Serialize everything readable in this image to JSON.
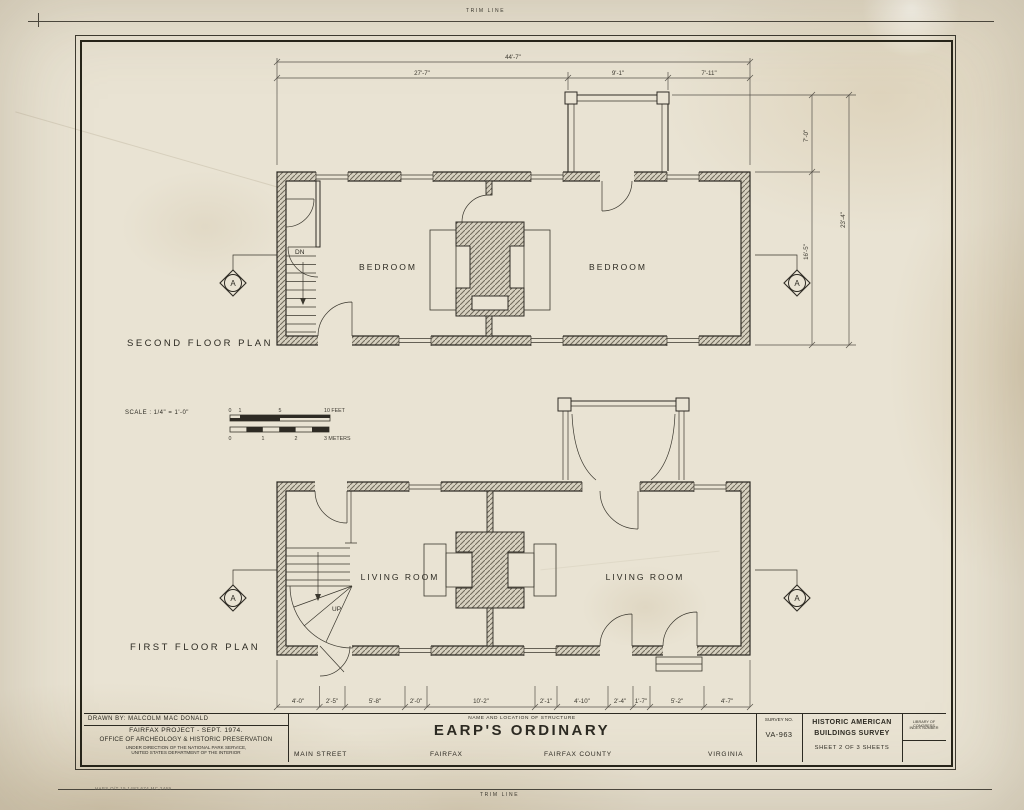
{
  "sheet": {
    "trim_top": "TRIM LINE",
    "trim_bottom": "TRIM LINE",
    "print_code": "HABS O/T 15 1483 674 MC 2469"
  },
  "plans": {
    "second": {
      "title": "SECOND FLOOR PLAN",
      "room_left": "BEDROOM",
      "room_right": "BEDROOM",
      "stair": "DN"
    },
    "first": {
      "title": "FIRST FLOOR PLAN",
      "room_left": "LIVING ROOM",
      "room_right": "LIVING ROOM",
      "stair": "UP"
    }
  },
  "marker": {
    "letter": "A"
  },
  "dims": {
    "top_overall": "44'-7\"",
    "top": [
      "27'-7\"",
      "9'-1\"",
      "7'-11\""
    ],
    "right": {
      "upper": "7'-0\"",
      "lower": "16'-5\"",
      "overall": "23'-4\""
    },
    "bottom": [
      "4'-0\"",
      "2'-5\"",
      "5'-8\"",
      "2'-0\"",
      "10'-2\"",
      "2'-1\"",
      "4'-10\"",
      "2'-4\"",
      "1'-7\"",
      "5'-2\"",
      "4'-7\""
    ]
  },
  "scale": {
    "label": "SCALE :    1/4\" = 1'-0\"",
    "feet": [
      "0",
      "1",
      "5",
      "10 FEET"
    ],
    "meters": [
      "0",
      "1",
      "2",
      "3 METERS"
    ]
  },
  "title_block": {
    "drawn_by": "DRAWN BY: MALCOLM   MAC DONALD",
    "project": "FAIRFAX   PROJECT - SEPT. 1974.",
    "office": "OFFICE  OF  ARCHEOLOGY  &  HISTORIC  PRESERVATION",
    "under1": "UNDER DIRECTION OF THE NATIONAL PARK SERVICE,",
    "under2": "UNITED STATES DEPARTMENT OF THE INTERIOR",
    "name_label": "NAME AND LOCATION OF STRUCTURE",
    "structure_name": "EARP'S  ORDINARY",
    "street": "MAIN  STREET",
    "city": "FAIRFAX",
    "county": "FAIRFAX  COUNTY",
    "state": "VIRGINIA",
    "survey_label": "SURVEY NO.",
    "survey_no": "VA-963",
    "habs1": "HISTORIC AMERICAN",
    "habs2": "BUILDINGS SURVEY",
    "sheet_info": "SHEET  2   OF  3   SHEETS",
    "loc1": "LIBRARY OF CONGRESS",
    "loc2": "INDEX NUMBER"
  }
}
